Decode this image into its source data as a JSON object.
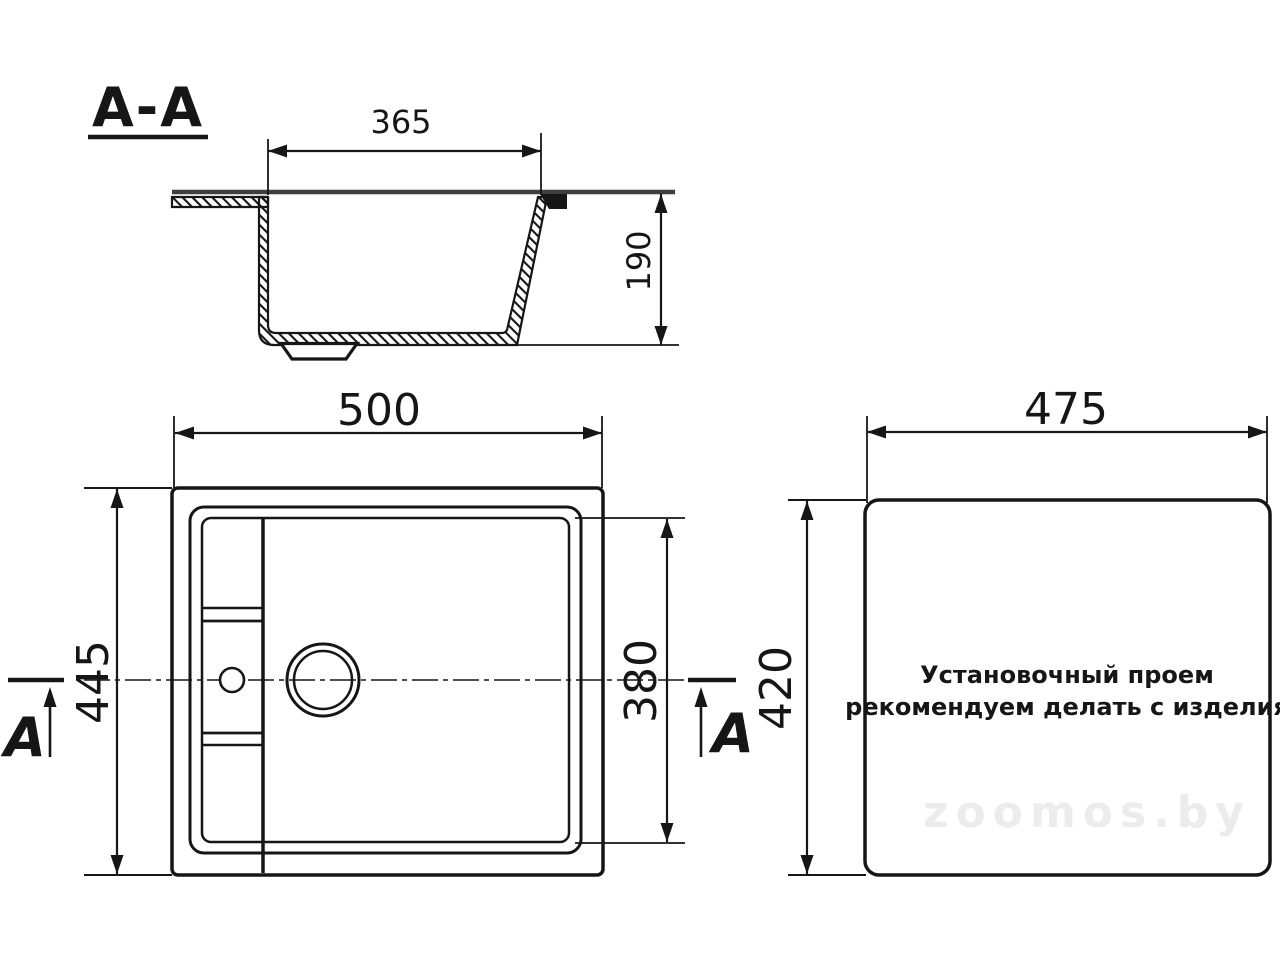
{
  "section_view": {
    "label": "A-A",
    "bowl_width_dim": "365",
    "bowl_depth_dim": "190"
  },
  "plan_view": {
    "overall_width_dim": "500",
    "overall_depth_dim": "445",
    "bowl_inner_depth_dim": "380",
    "section_letter_left": "A",
    "section_letter_right": "A"
  },
  "cutout_view": {
    "cutout_width_dim": "475",
    "cutout_height_dim": "420",
    "note_line1": "Установочный проем",
    "note_line2": "рекомендуем делать с изделия"
  },
  "watermark": "zoomos.by",
  "colors": {
    "line": "#161616",
    "top_edge": "#3e3e3e",
    "watermark": "#ececec",
    "bg": "#ffffff"
  }
}
